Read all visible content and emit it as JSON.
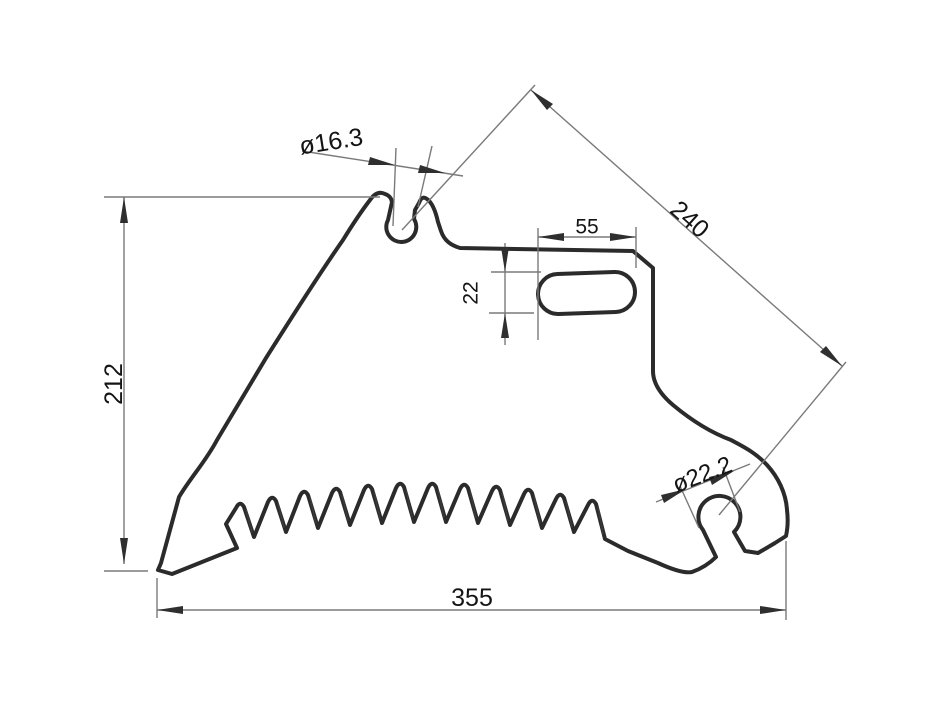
{
  "drawing": {
    "background": "#ffffff",
    "colors": {
      "outline": "#2b2b2b",
      "dimension_lines": "#7a7a7a",
      "text": "#141414"
    },
    "dimensions": {
      "left_height": "212",
      "bottom_width": "355",
      "diagonal_hole_distance": "240",
      "top_notch_diameter": "ø16.3",
      "slot_length": "55",
      "slot_width": "22",
      "keyhole_diameter": "ø22.2"
    }
  }
}
